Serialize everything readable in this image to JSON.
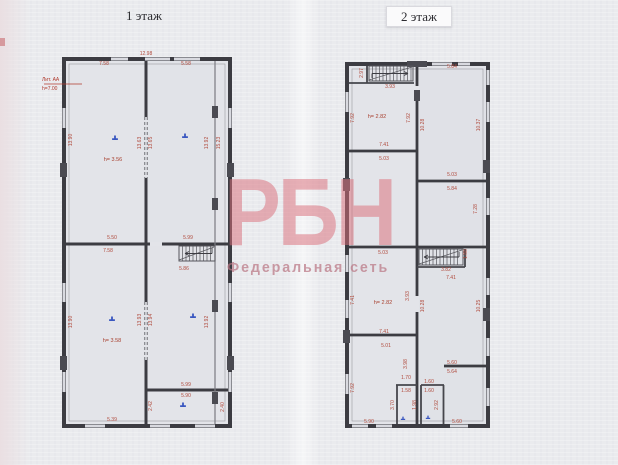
{
  "document": {
    "floor1_title": "1 этаж",
    "floor2_title": "2 этаж"
  },
  "watermark": {
    "logo": "РБН",
    "subtitle": "Федеральная сеть",
    "logo_color": "#db707b",
    "subtitle_color": "#ba7684"
  },
  "colors": {
    "dimension_text": "#b04a3c",
    "room_marker": "#3a57c0",
    "walls": "#3c3c42",
    "paper": "#eaebee"
  },
  "floor1": {
    "lit_label_line1": "Лит. АА",
    "lit_label_line2": "h=7.00",
    "heights": [
      "h= 3.56",
      "h= 3.58"
    ],
    "dims": [
      "12.98",
      "7.58",
      "5.58",
      "13.90",
      "13.63",
      "13.65",
      "13.92",
      "15.23",
      "5.50",
      "5.99",
      "7.58",
      "5.86",
      "13.93",
      "13.94",
      "13.92",
      "13.90",
      "5.99",
      "5.90",
      "2.40",
      "2.42",
      "5.39"
    ]
  },
  "floor2": {
    "heights": [
      "h= 2.82",
      "h= 2.82"
    ],
    "dims": [
      "5.84",
      "3.93",
      "2.97",
      "7.92",
      "7.92",
      "10.28",
      "10.37",
      "7.41",
      "5.03",
      "5.03",
      "5.84",
      "7.28",
      "5.03",
      "3.82",
      "1.88",
      "7.41",
      "7.41",
      "3.93",
      "10.28",
      "10.25",
      "7.41",
      "5.01",
      "3.98",
      "5.60",
      "5.64",
      "1.70",
      "1.60",
      "1.58",
      "1.60",
      "1.98",
      "2.92",
      "3.70",
      "5.90",
      "5.60",
      "7.92"
    ]
  }
}
